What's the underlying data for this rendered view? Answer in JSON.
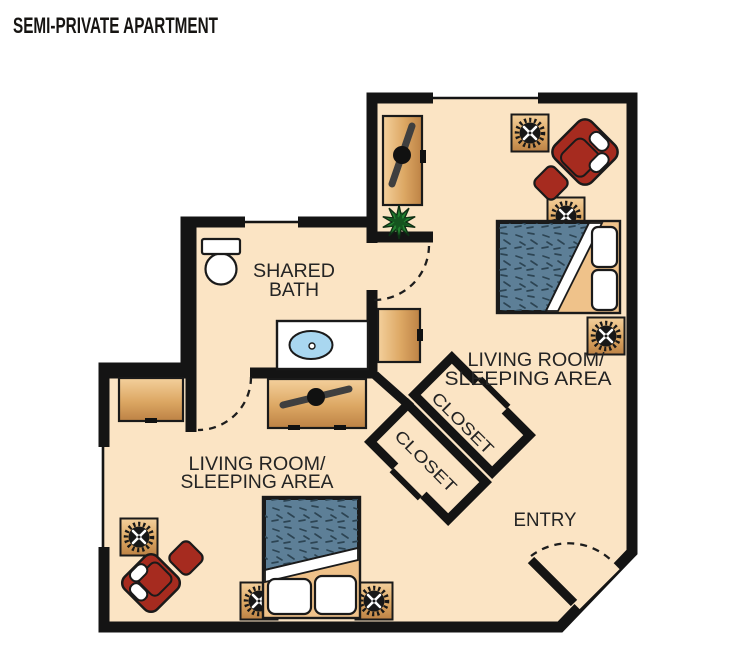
{
  "title": "SEMI-PRIVATE APARTMENT",
  "rooms": {
    "bedroom_upper": {
      "line1": "LIVING ROOM/",
      "line2": "SLEEPING AREA"
    },
    "bedroom_lower": {
      "line1": "LIVING ROOM/",
      "line2": "SLEEPING AREA"
    },
    "bath": {
      "line1": "SHARED",
      "line2": "BATH"
    },
    "entry": {
      "label": "ENTRY"
    },
    "closet_upper": {
      "label": "CLOSET"
    },
    "closet_lower": {
      "label": "CLOSET"
    }
  },
  "furniture_icons": [
    "bed-icon",
    "armchair-icon",
    "ottoman-icon",
    "side-table-lamp-icon",
    "tv-icon",
    "tv-dresser-icon",
    "dresser-icon",
    "wardrobe-icon",
    "plant-icon",
    "toilet-icon",
    "vanity-sink-icon",
    "door-swing-icon",
    "window-icon"
  ],
  "colors": {
    "floor": "#FBE4C4",
    "wall": "#141414",
    "wood_light": "#F4D09C",
    "wood_mid": "#DCA763",
    "wood_dark": "#BD8245",
    "wood_flat": "#EFC28A",
    "bed_blanket": "#5D7F97",
    "bed_speckle": "#2C4453",
    "chair_red": "#A62B1F",
    "plant_green": "#238030",
    "plant_dark": "#14541E",
    "sink_blue": "#A9D7F0",
    "tv_gray": "#3F3F3F",
    "label_text": "#242424",
    "title_text": "#161412"
  }
}
